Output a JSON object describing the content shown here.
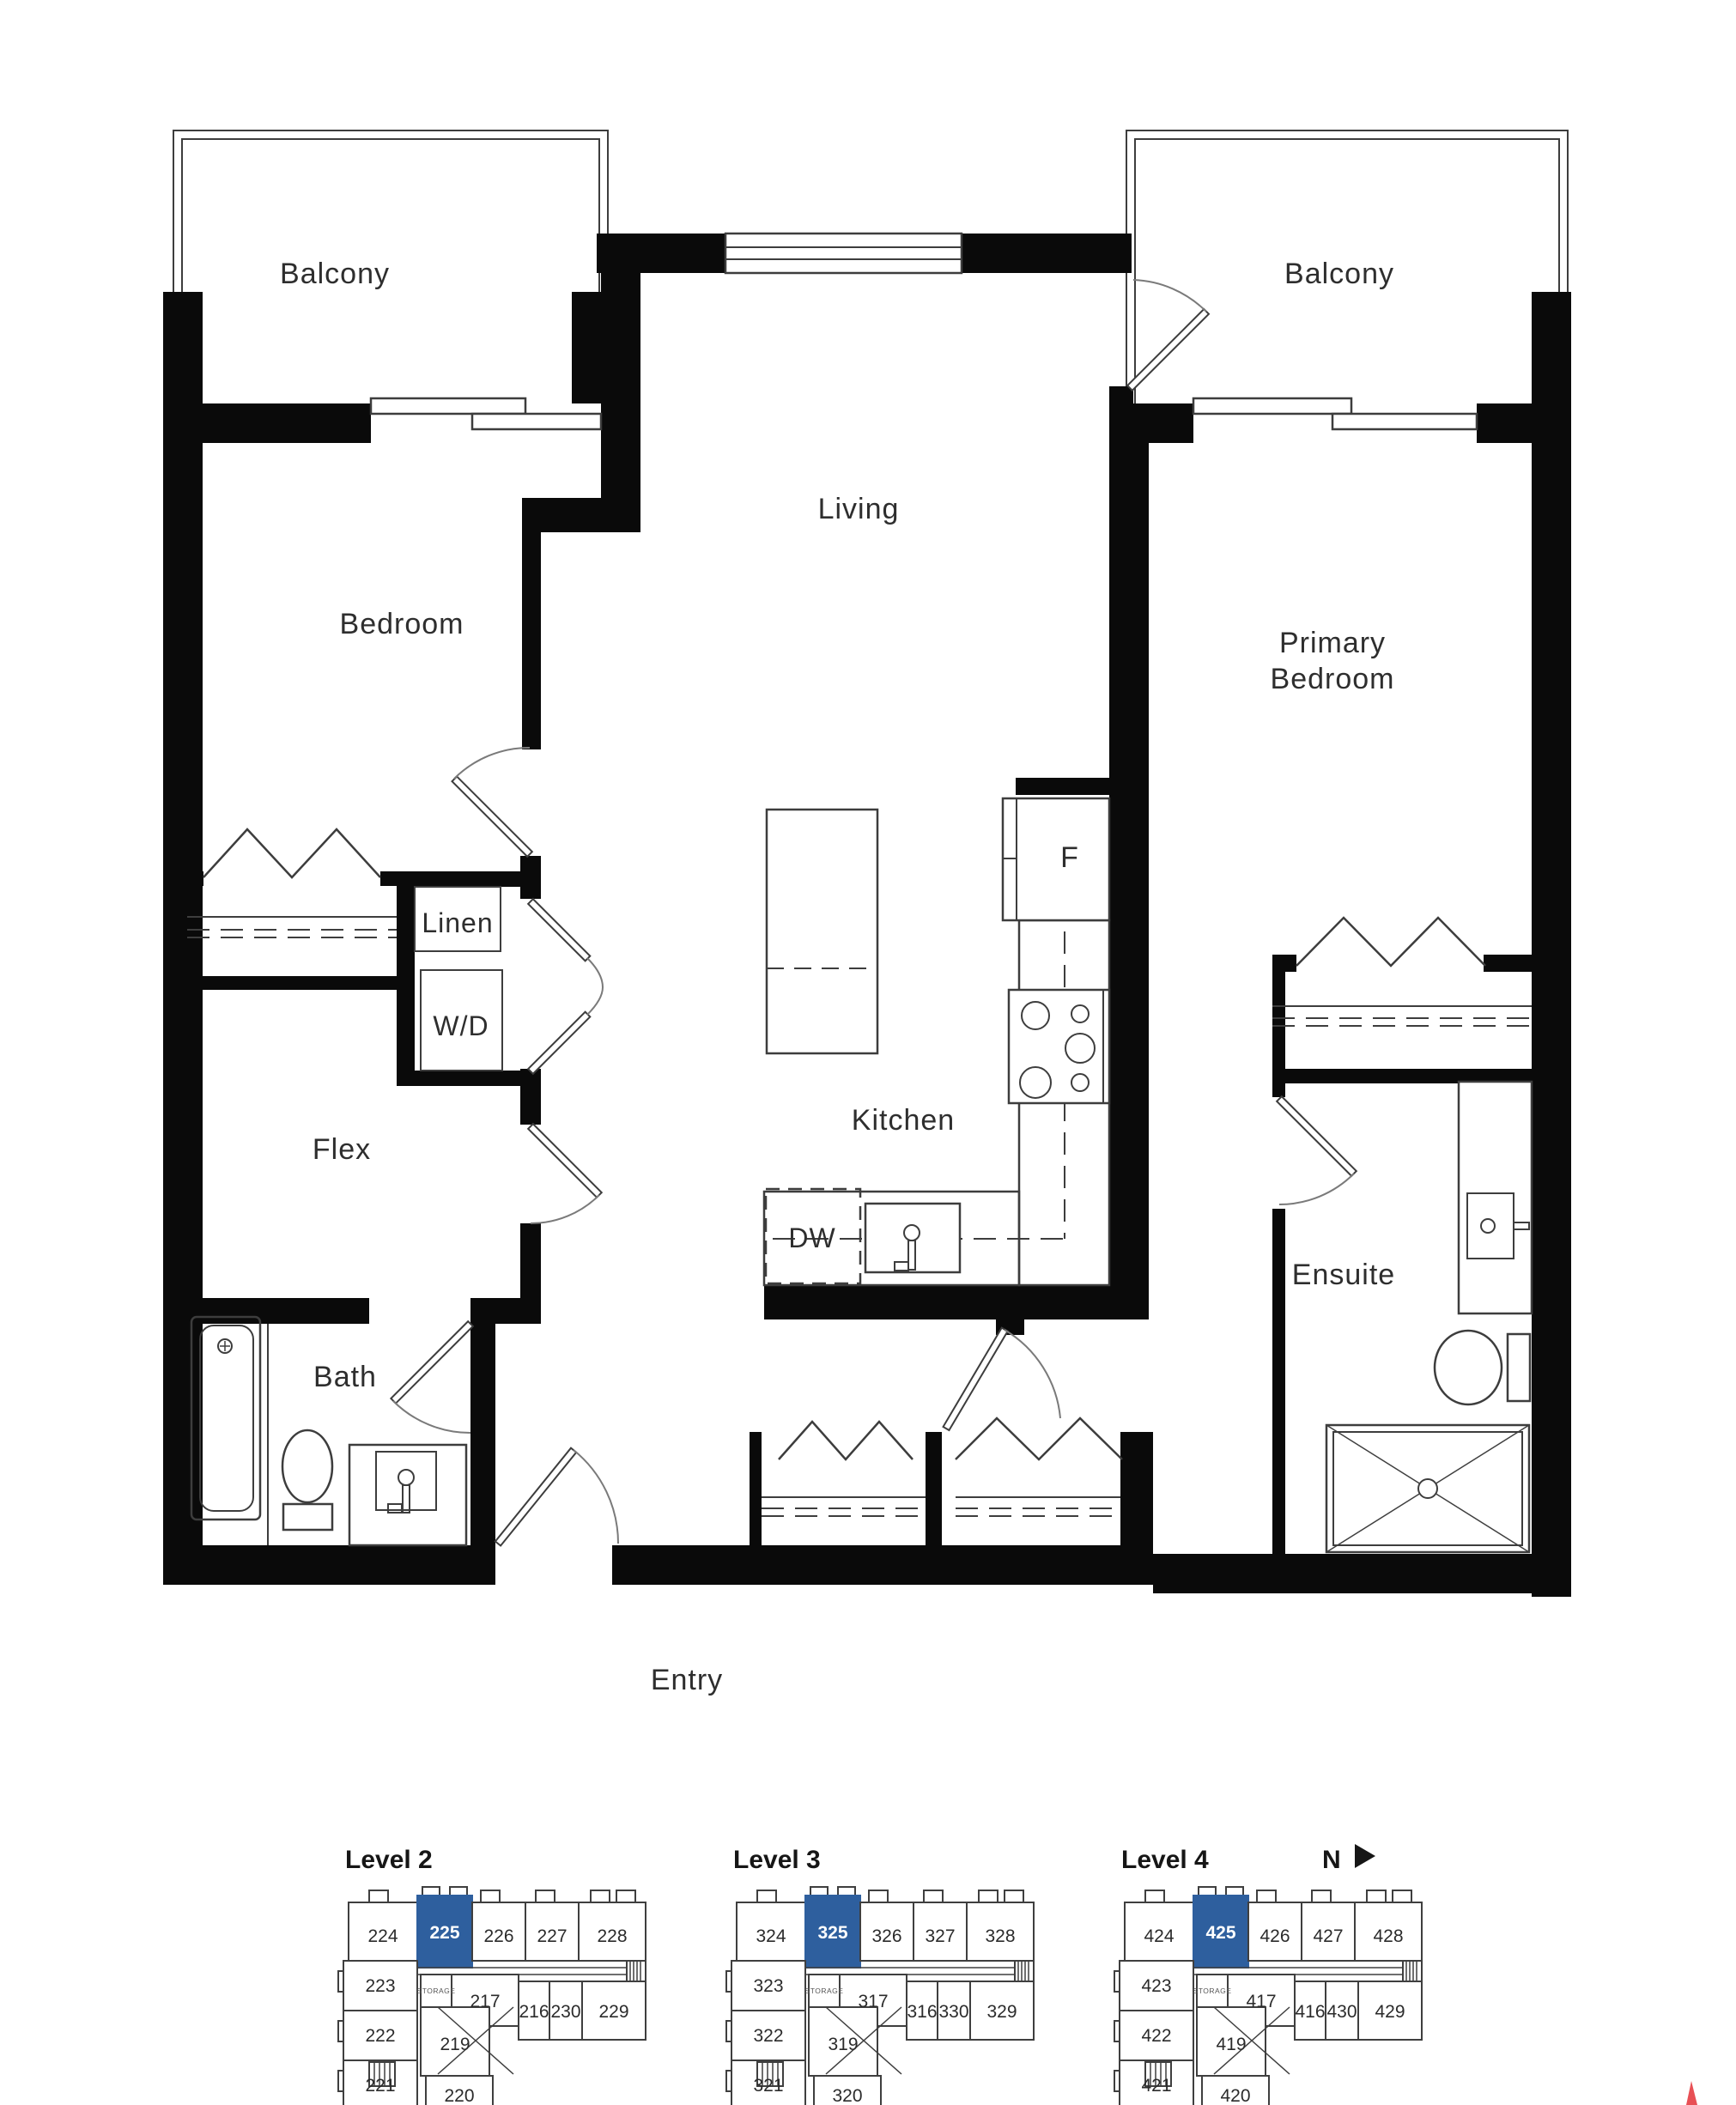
{
  "colors": {
    "background": "#ffffff",
    "wall": "#0a0a0a",
    "line": "#3d3d3d",
    "text": "#2e2e2e",
    "highlight": "#2e5f9e",
    "highlight_text": "#ffffff",
    "north_mark": "#e85055"
  },
  "floor_plan": {
    "rooms": {
      "balcony_left": "Balcony",
      "balcony_right": "Balcony",
      "living": "Living",
      "bedroom": "Bedroom",
      "primary_bedroom": [
        "Primary",
        "Bedroom"
      ],
      "linen": "Linen",
      "washer_dryer": "W/D",
      "flex": "Flex",
      "fridge": "F",
      "kitchen": "Kitchen",
      "dishwasher": "DW",
      "ensuite": "Ensuite",
      "bath": "Bath",
      "entry": "Entry"
    }
  },
  "keyplans": {
    "north_label": "N",
    "levels": [
      {
        "label": "Level 2",
        "highlighted_unit": "225",
        "top_row": [
          "224",
          "225",
          "226",
          "227",
          "228"
        ],
        "left_column": [
          "223",
          "222",
          "221"
        ],
        "middle_row": [
          "217",
          "216",
          "230",
          "229"
        ],
        "lower": [
          "219",
          "220"
        ],
        "storage": "STORAGE"
      },
      {
        "label": "Level 3",
        "highlighted_unit": "325",
        "top_row": [
          "324",
          "325",
          "326",
          "327",
          "328"
        ],
        "left_column": [
          "323",
          "322",
          "321"
        ],
        "middle_row": [
          "317",
          "316",
          "330",
          "329"
        ],
        "lower": [
          "319",
          "320"
        ],
        "storage": "STORAGE"
      },
      {
        "label": "Level 4",
        "highlighted_unit": "425",
        "top_row": [
          "424",
          "425",
          "426",
          "427",
          "428"
        ],
        "left_column": [
          "423",
          "422",
          "421"
        ],
        "middle_row": [
          "417",
          "416",
          "430",
          "429"
        ],
        "lower": [
          "419",
          "420"
        ],
        "storage": "STORAGE"
      }
    ]
  }
}
